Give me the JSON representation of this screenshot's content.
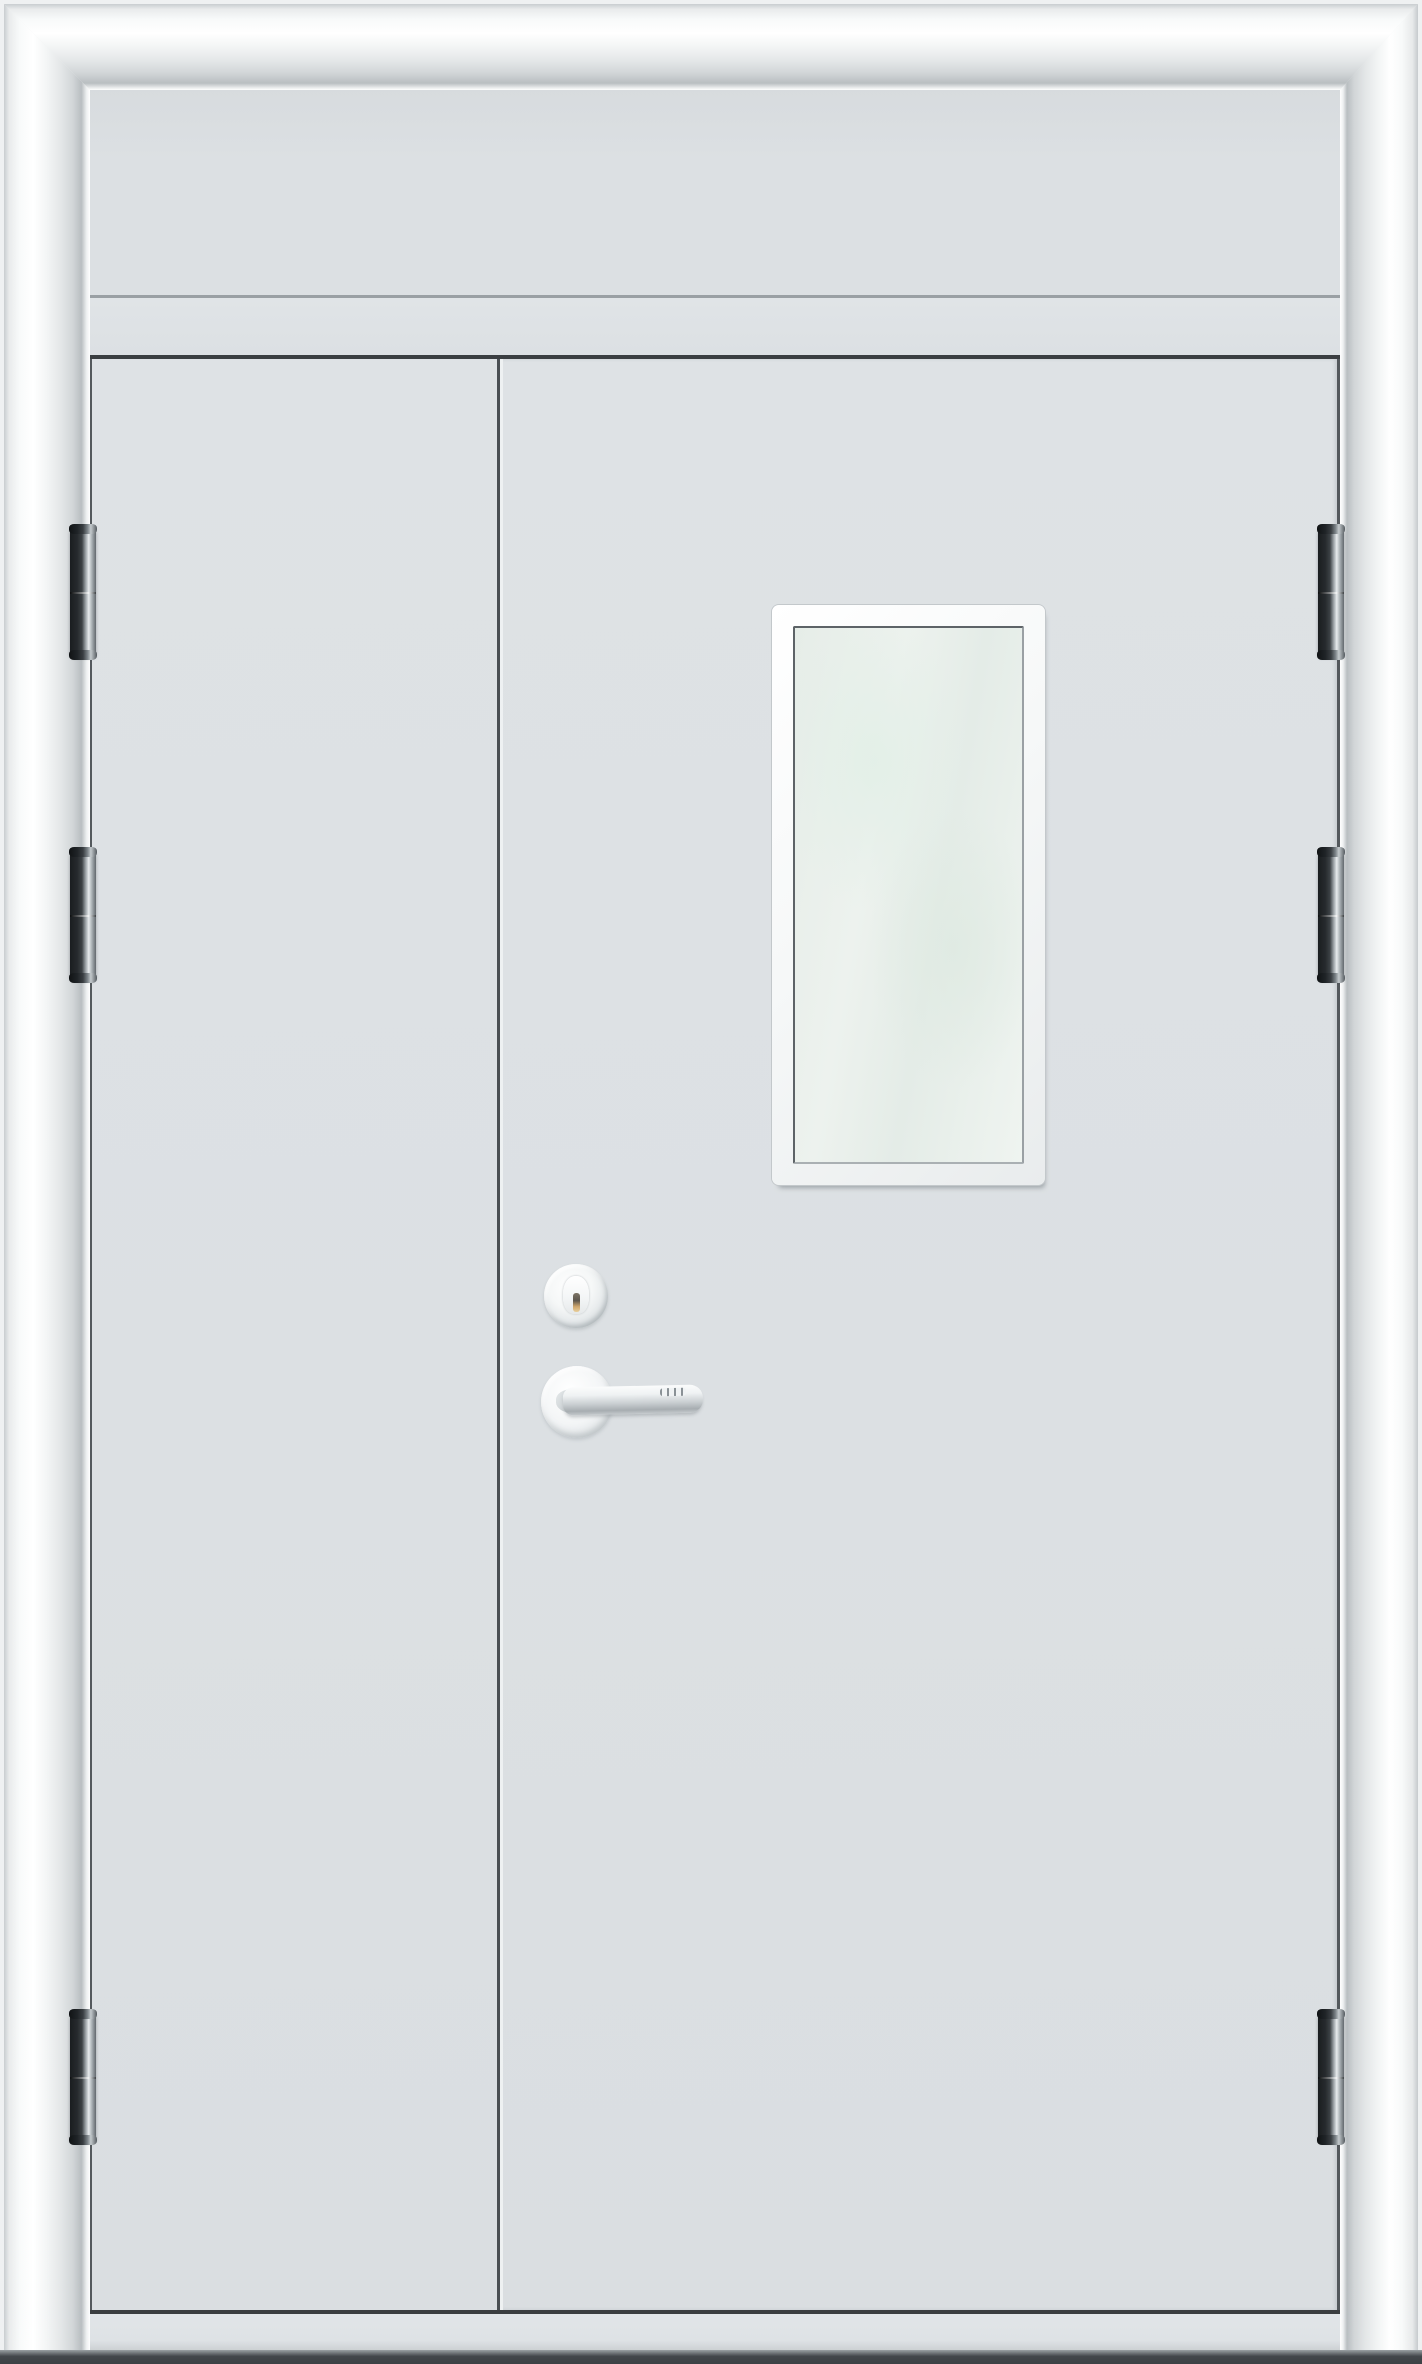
{
  "scene": {
    "subject": "White double metal door with transom panel, unequal leaves, glazed vision window, cylinder lock, lever handle and barrel hinges",
    "view": "front elevation product photo",
    "background": "seamless white"
  },
  "palette": {
    "page_bg": "#eff1f2",
    "frame_white": "#ffffff",
    "frame_shadow": "#b9bec1",
    "door_surface": "#dce0e3",
    "panel_line_gray": "#9aa0a4",
    "edge_dark": "#3a3e41",
    "gap_line_dark": "#54595d",
    "stile_highlight": "#eef1f2",
    "glass_base": "#e8efe9",
    "glass_tint": "rgba(223,234,226,0.85)",
    "window_hairline": "#c3c8cb",
    "window_inner_dark": "#5d6367",
    "hinge_dark": "#1a1d20",
    "hinge_steel": "#e7ebed",
    "chrome_light": "#fbfcfc",
    "chrome_mid": "#c9ced1",
    "chrome_deep": "#a7adb1",
    "keyway_gold": "#cfa76e",
    "threshold_gray": "#e1e5e8",
    "floor_dark": "#43474b"
  },
  "structure": {
    "frame": {
      "style": "rounded glossy white molding with mitered corners",
      "head_height": 86,
      "left_jamb_width": 86,
      "right_jamb_width": 78
    },
    "transom": {
      "type": "fixed blank panel",
      "top": 88,
      "bottom": 295
    },
    "doors": {
      "top": 355,
      "bottom": 2314,
      "meeting_stile_x": 500,
      "left_leaf": "narrow inactive leaf, blank",
      "right_leaf": "wide active leaf with vision window and lockset"
    },
    "vision_window": {
      "x": 772,
      "y": 605,
      "width": 273,
      "height": 580,
      "frame": "white rounded frame ~21px with dark inner hairline",
      "glazing": "frosted pale-green glass"
    },
    "lockset": {
      "cylinder": {
        "cx": 576,
        "cy": 1296,
        "radius": 32,
        "finish": "satin chrome",
        "keyway": "vertical slot with brass glint"
      },
      "lever": {
        "rose_cx": 577,
        "rose_cy": 1402,
        "rose_radius": 36,
        "finish": "satin chrome",
        "direction": "pointing right",
        "tip_x": 702
      }
    },
    "hinges": {
      "per_side": 3,
      "sides": [
        "left",
        "right"
      ],
      "labels": [
        "top",
        "upper-middle",
        "bottom"
      ],
      "positions_y": [
        528,
        851,
        2013
      ],
      "x": {
        "left": 70,
        "right": 1318
      },
      "width": 26,
      "height": 128,
      "finish": "dark steel barrel hinge with bright knuckle"
    },
    "threshold": {
      "y": 2314,
      "height": 38
    },
    "floor_shadow": {
      "y": 2350,
      "height": 14
    }
  }
}
